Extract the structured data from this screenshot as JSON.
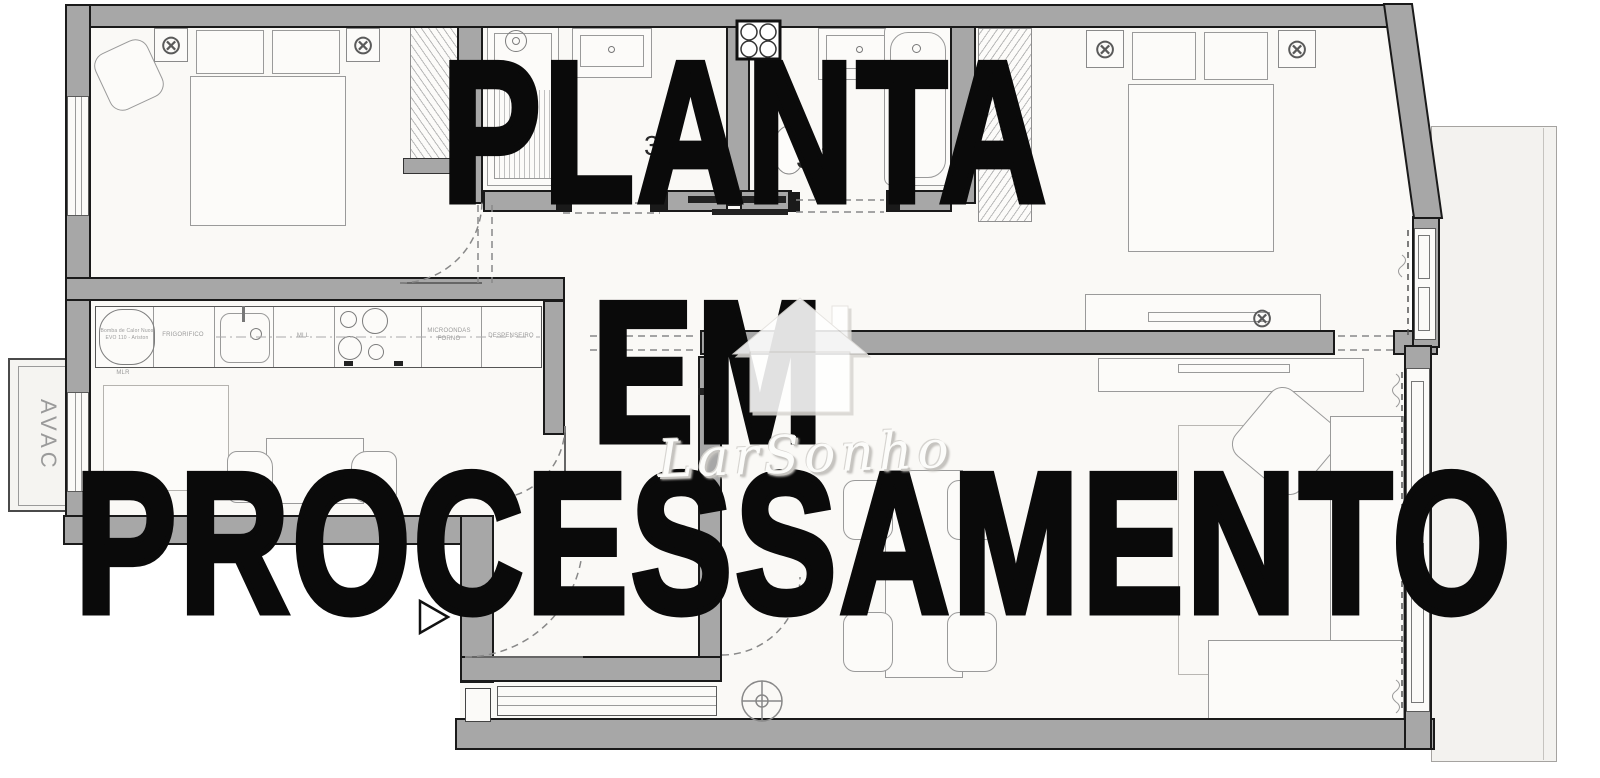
{
  "watermark": {
    "lines": [
      "PLANTA",
      "EM",
      "PROCESSAMENTO"
    ],
    "color": "#0a0a0a"
  },
  "logo": {
    "script": "LarSonho"
  },
  "rooms": {
    "avac_label": "AVAC",
    "bath1_area": "3,",
    "bath2_area": "3,",
    "area_sup": "2"
  },
  "kitchen": {
    "heat_pump_l1": "Bomba de Calor Nuos",
    "heat_pump_l2": "EVO 110 - Ariston",
    "fridge": "FRIGORIFICO",
    "dishwasher": "MLL",
    "microwave_l1": "MICROONDAS",
    "microwave_l2": "FORNO",
    "pantry": "DESPENSEIRO",
    "washer": "MLR"
  },
  "icons": {
    "ceiling_light": "⊗"
  },
  "colors": {
    "wall": "#a7a7a7",
    "outline": "#1a1a1a",
    "floor": "#faf9f6",
    "balcony": "#f3f2ef",
    "watermark": "#0a0a0a"
  }
}
